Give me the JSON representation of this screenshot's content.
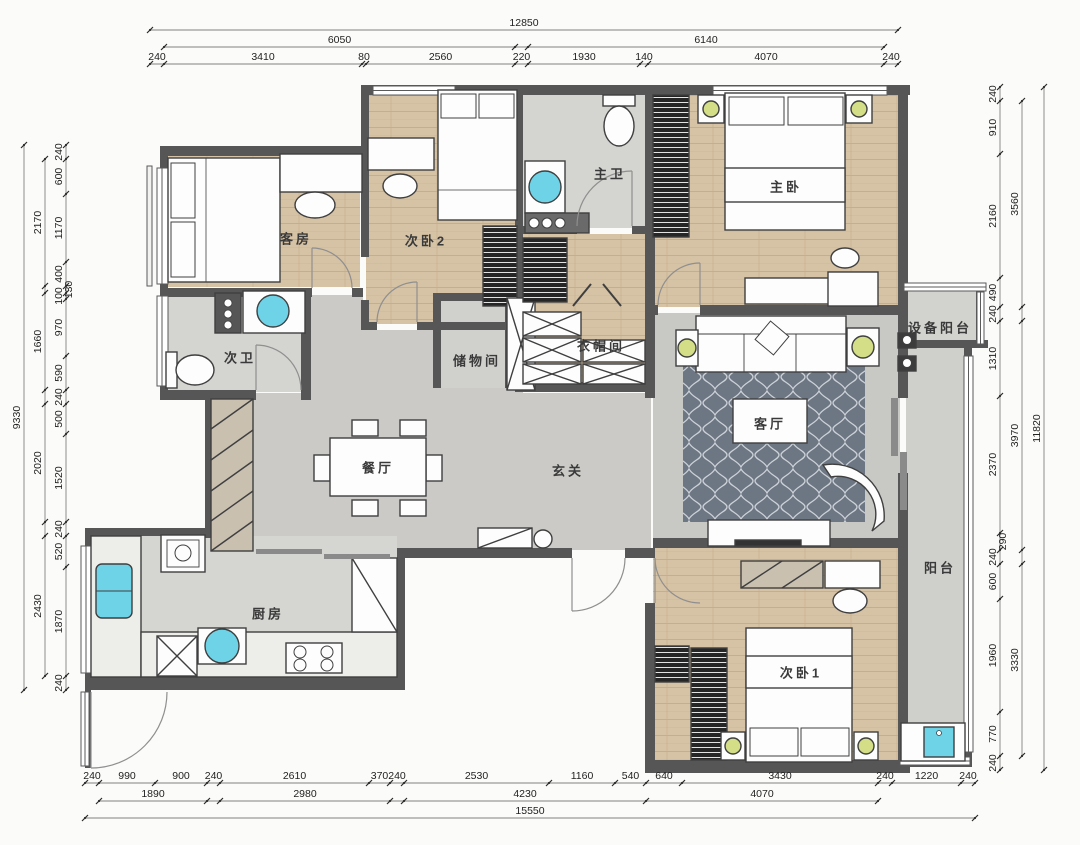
{
  "title": "apartment-floor-plan",
  "colors": {
    "wall": "#565656",
    "wood_floor": "#d6c2a4",
    "tile_floor": "#cbcac6",
    "bath_floor": "#d4d4d0",
    "rug": "#6d7683",
    "fixture_cyan": "#6fd3e8",
    "lamp_green": "#d3de86",
    "dim_text": "#222222"
  },
  "rooms": [
    {
      "id": "guest-room",
      "label": "客房",
      "x": 296,
      "y": 238
    },
    {
      "id": "bedroom-2",
      "label": "次卧2",
      "x": 426,
      "y": 240
    },
    {
      "id": "master-bath",
      "label": "主卫",
      "x": 610,
      "y": 173
    },
    {
      "id": "master-bedroom",
      "label": "主卧",
      "x": 786,
      "y": 186
    },
    {
      "id": "second-bath",
      "label": "次卫",
      "x": 240,
      "y": 357
    },
    {
      "id": "storage-room",
      "label": "储物间",
      "x": 477,
      "y": 360
    },
    {
      "id": "cloakroom",
      "label": "衣帽间",
      "x": 601,
      "y": 345
    },
    {
      "id": "equipment-balcony",
      "label": "设备阳台",
      "x": 940,
      "y": 327
    },
    {
      "id": "living-room",
      "label": "客厅",
      "x": 770,
      "y": 423
    },
    {
      "id": "dining-room",
      "label": "餐厅",
      "x": 378,
      "y": 467
    },
    {
      "id": "foyer",
      "label": "玄关",
      "x": 568,
      "y": 470
    },
    {
      "id": "balcony",
      "label": "阳台",
      "x": 940,
      "y": 567
    },
    {
      "id": "kitchen",
      "label": "厨房",
      "x": 268,
      "y": 613
    },
    {
      "id": "bedroom-1",
      "label": "次卧1",
      "x": 801,
      "y": 672
    }
  ],
  "dimensions": {
    "chains": [
      {
        "id": "top-outer",
        "axis": "h",
        "pos": 30,
        "segs": [
          {
            "label": "12850",
            "from": 150,
            "to": 898
          }
        ]
      },
      {
        "id": "top-mid",
        "axis": "h",
        "pos": 47,
        "segs": [
          {
            "label": "6050",
            "from": 164,
            "to": 515
          },
          {
            "label": "6140",
            "from": 528,
            "to": 884
          }
        ]
      },
      {
        "id": "top-inner",
        "axis": "h",
        "pos": 64,
        "segs": [
          {
            "label": "240",
            "from": 150,
            "to": 164
          },
          {
            "label": "3410",
            "from": 164,
            "to": 362
          },
          {
            "label": "80",
            "from": 362,
            "to": 366
          },
          {
            "label": "2560",
            "from": 366,
            "to": 515
          },
          {
            "label": "220",
            "from": 515,
            "to": 528
          },
          {
            "label": "1930",
            "from": 528,
            "to": 640
          },
          {
            "label": "140",
            "from": 640,
            "to": 648
          },
          {
            "label": "4070",
            "from": 648,
            "to": 884
          },
          {
            "label": "240",
            "from": 884,
            "to": 898
          }
        ]
      },
      {
        "id": "left-outer",
        "axis": "v",
        "pos": 24,
        "segs": [
          {
            "label": "9330",
            "from": 145,
            "to": 690
          }
        ]
      },
      {
        "id": "left-mid",
        "axis": "v",
        "pos": 45,
        "segs": [
          {
            "label": "2170",
            "from": 159,
            "to": 286
          },
          {
            "label": "1660",
            "from": 293,
            "to": 390
          },
          {
            "label": "2020",
            "from": 404,
            "to": 522
          },
          {
            "label": "2430",
            "from": 536,
            "to": 676
          }
        ]
      },
      {
        "id": "left-inner",
        "axis": "v",
        "pos": 66,
        "segs": [
          {
            "label": "240",
            "from": 145,
            "to": 159
          },
          {
            "label": "600",
            "from": 159,
            "to": 194
          },
          {
            "label": "1170",
            "from": 194,
            "to": 262
          },
          {
            "label": "400",
            "from": 262,
            "to": 286
          },
          {
            "label": "130",
            "from": 286,
            "to": 293,
            "off": 10
          },
          {
            "label": "100",
            "from": 293,
            "to": 299
          },
          {
            "label": "970",
            "from": 299,
            "to": 356
          },
          {
            "label": "590",
            "from": 356,
            "to": 390
          },
          {
            "label": "240",
            "from": 390,
            "to": 404
          },
          {
            "label": "500",
            "from": 404,
            "to": 434
          },
          {
            "label": "1520",
            "from": 434,
            "to": 522
          },
          {
            "label": "240",
            "from": 522,
            "to": 536
          },
          {
            "label": "520",
            "from": 536,
            "to": 567
          },
          {
            "label": "1870",
            "from": 567,
            "to": 676
          },
          {
            "label": "240",
            "from": 676,
            "to": 690
          }
        ]
      },
      {
        "id": "right-inner",
        "axis": "v",
        "pos": 1000,
        "segs": [
          {
            "label": "240",
            "from": 87,
            "to": 101
          },
          {
            "label": "910",
            "from": 101,
            "to": 154
          },
          {
            "label": "2160",
            "from": 154,
            "to": 278
          },
          {
            "label": "490",
            "from": 278,
            "to": 307
          },
          {
            "label": "240",
            "from": 307,
            "to": 321
          },
          {
            "label": "1310",
            "from": 321,
            "to": 396
          },
          {
            "label": "2370",
            "from": 396,
            "to": 533
          },
          {
            "label": "290",
            "from": 533,
            "to": 550,
            "off": 10
          },
          {
            "label": "240",
            "from": 550,
            "to": 564
          },
          {
            "label": "600",
            "from": 564,
            "to": 599
          },
          {
            "label": "1960",
            "from": 599,
            "to": 712
          },
          {
            "label": "770",
            "from": 712,
            "to": 756
          },
          {
            "label": "240",
            "from": 756,
            "to": 770
          }
        ]
      },
      {
        "id": "right-mid",
        "axis": "v",
        "pos": 1022,
        "segs": [
          {
            "label": "3560",
            "from": 101,
            "to": 307
          },
          {
            "label": "3970",
            "from": 321,
            "to": 550
          },
          {
            "label": "3330",
            "from": 564,
            "to": 756
          }
        ]
      },
      {
        "id": "right-outer",
        "axis": "v",
        "pos": 1044,
        "segs": [
          {
            "label": "11820",
            "from": 87,
            "to": 770
          }
        ]
      },
      {
        "id": "bottom-inner",
        "axis": "h",
        "pos": 783,
        "segs": [
          {
            "label": "240",
            "from": 85,
            "to": 99
          },
          {
            "label": "990",
            "from": 99,
            "to": 155
          },
          {
            "label": "900",
            "from": 155,
            "to": 207
          },
          {
            "label": "240",
            "from": 207,
            "to": 220
          },
          {
            "label": "2610",
            "from": 220,
            "to": 369
          },
          {
            "label": "370",
            "from": 369,
            "to": 390
          },
          {
            "label": "240",
            "from": 390,
            "to": 404
          },
          {
            "label": "2530",
            "from": 404,
            "to": 549
          },
          {
            "label": "1160",
            "from": 549,
            "to": 615
          },
          {
            "label": "540",
            "from": 615,
            "to": 646
          },
          {
            "label": "640",
            "from": 646,
            "to": 682
          },
          {
            "label": "3430",
            "from": 682,
            "to": 878
          },
          {
            "label": "240",
            "from": 878,
            "to": 892
          },
          {
            "label": "1220",
            "from": 892,
            "to": 961
          },
          {
            "label": "240",
            "from": 961,
            "to": 975
          }
        ]
      },
      {
        "id": "bottom-mid",
        "axis": "h",
        "pos": 801,
        "segs": [
          {
            "label": "1890",
            "from": 99,
            "to": 207
          },
          {
            "label": "2980",
            "from": 220,
            "to": 390
          },
          {
            "label": "4230",
            "from": 404,
            "to": 646
          },
          {
            "label": "4070",
            "from": 646,
            "to": 878
          }
        ]
      },
      {
        "id": "bottom-outer",
        "axis": "h",
        "pos": 818,
        "segs": [
          {
            "label": "15550",
            "from": 85,
            "to": 975
          }
        ]
      }
    ]
  }
}
